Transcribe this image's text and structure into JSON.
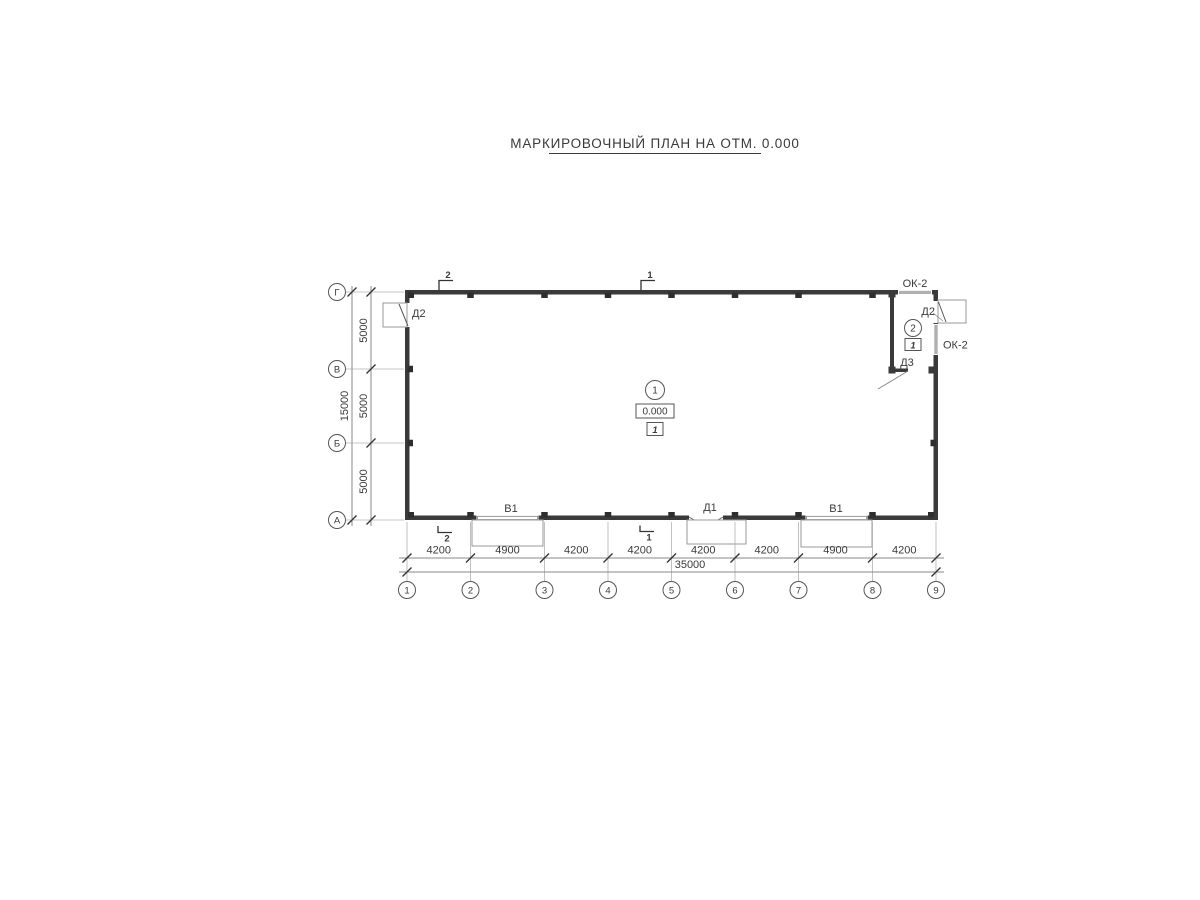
{
  "title": "МАРКИРОВОЧНЫЙ ПЛАН НА ОТМ. 0.000",
  "grid_axes": {
    "bottom": [
      "1",
      "2",
      "3",
      "4",
      "5",
      "6",
      "7",
      "8",
      "9"
    ],
    "left": [
      "Г",
      "В",
      "Б",
      "А"
    ]
  },
  "dimensions": {
    "bottom_segments": [
      "4200",
      "4900",
      "4200",
      "4200",
      "4200",
      "4200",
      "4900",
      "4200"
    ],
    "bottom_total": "35000",
    "left_segments": [
      "5000",
      "5000",
      "5000"
    ],
    "left_total": "15000"
  },
  "section_marks": {
    "top_left": "2",
    "top_right": "1",
    "bottom_left": "2",
    "bottom_right": "1"
  },
  "openings": {
    "door_d2_left": "Д2",
    "door_d2_right": "Д2",
    "door_d3": "Д3",
    "door_d1": "Д1",
    "gate_v1_left": "В1",
    "gate_v1_right": "В1",
    "window_ok2_top": "ОК-2",
    "window_ok2_right": "ОК-2"
  },
  "rooms": {
    "room1": {
      "number": "1",
      "elevation": "0.000",
      "finish_mark": "1"
    },
    "room2": {
      "number": "2",
      "finish_mark": "1"
    }
  },
  "colors": {
    "wall": "#3a3a3a",
    "thin_line": "#8a8a8a",
    "background": "#ffffff"
  }
}
